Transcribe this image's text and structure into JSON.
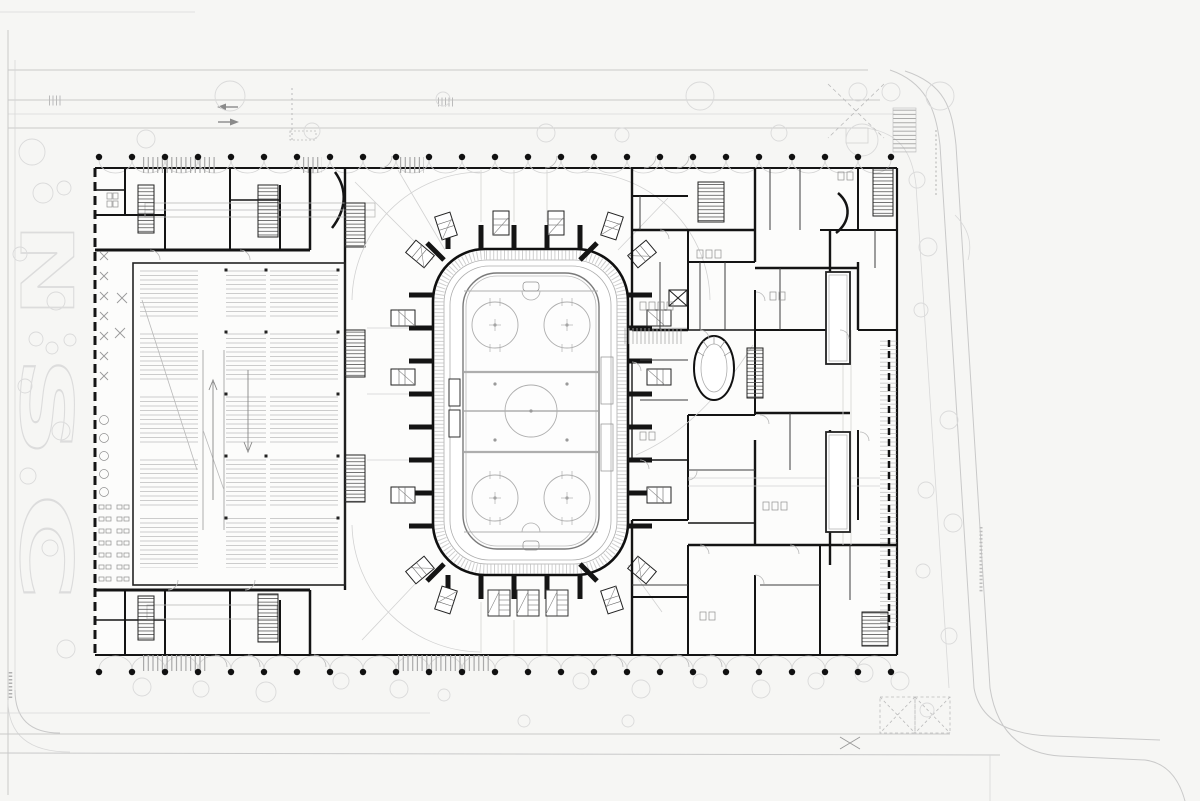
{
  "meta": {
    "drawing_type": "architectural floor plan",
    "subject": "ice rink arena ground floor with site"
  },
  "colors": {
    "background": "#f6f6f4",
    "walls": "#141414",
    "light_line": "#c9c9c9",
    "medium_line": "#9a9a9a",
    "tree_line": "#dadada",
    "column_dot": "#111111"
  },
  "plaza_letters": {
    "letter_1": "N",
    "letter_2": "S",
    "letter_3": "C"
  }
}
